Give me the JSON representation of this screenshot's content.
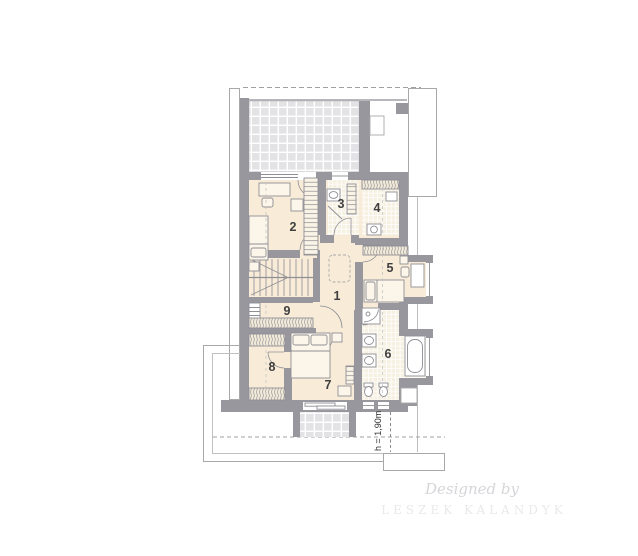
{
  "plan": {
    "type": "floor-plan",
    "floor": "attic / first floor",
    "rooms": [
      {
        "id": 1,
        "label": "1"
      },
      {
        "id": 2,
        "label": "2"
      },
      {
        "id": 3,
        "label": "3"
      },
      {
        "id": 4,
        "label": "4"
      },
      {
        "id": 5,
        "label": "5"
      },
      {
        "id": 6,
        "label": "6"
      },
      {
        "id": 7,
        "label": "7"
      },
      {
        "id": 8,
        "label": "8"
      },
      {
        "id": 9,
        "label": "9"
      }
    ],
    "height_annotation": "h = 1,90m"
  },
  "watermark": {
    "script": "Designed by",
    "name": "LESZEK KALANDYK"
  },
  "colors": {
    "wall": "#98979e",
    "floor": "#f8ecd9",
    "tile": "#f7f1e3",
    "terrace_tile": "#e3e3e6",
    "furniture_stroke": "#8f8e94",
    "watermark_script": "#d6d6da",
    "watermark_name": "#e9e9ec"
  }
}
